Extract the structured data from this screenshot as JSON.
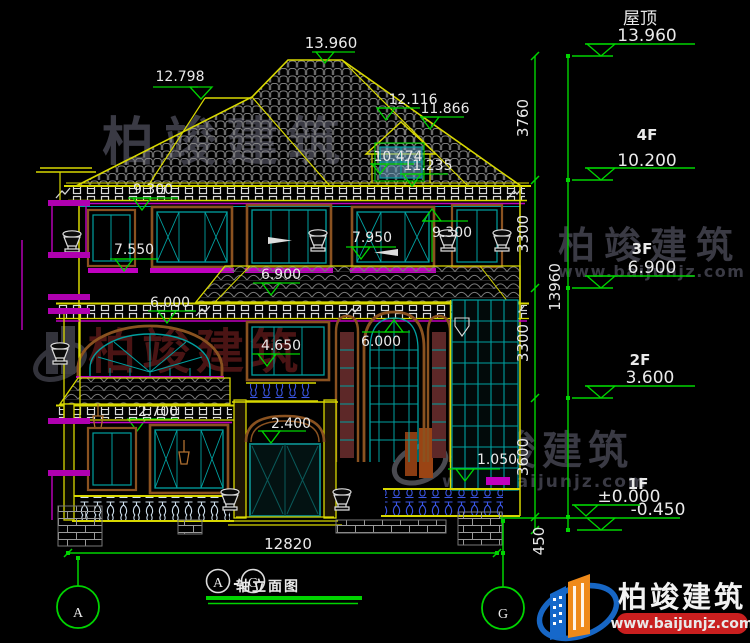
{
  "levels": [
    {
      "name": "屋顶",
      "elev": "13.960"
    },
    {
      "name": "4F",
      "elev": "10.200"
    },
    {
      "name": "3F",
      "elev": "6.900"
    },
    {
      "name": "2F",
      "elev": "3.600"
    },
    {
      "name": "1F",
      "elev": "±0.000",
      "elev_below": "-0.450"
    }
  ],
  "vertical_dims": {
    "s0": "3760",
    "s1": "3300",
    "s2": "3300",
    "s3": "3600",
    "s4": "450",
    "total": "13960"
  },
  "roof_dims": {
    "ridge": "13.960",
    "left_ridge": "12.798",
    "slope": "12.116",
    "dormer_ridge": "11.866",
    "dormer_window": "10.474",
    "dormer_eave": "11.235"
  },
  "facade_dims": {
    "eave_left": "9.300",
    "eave_right": "9.300",
    "window_3f_left": "7.550",
    "window_3f_right": "7.950",
    "canopy_2f": "6.900",
    "canopy_left": "6.000",
    "arch_2f": "6.000",
    "sill_2f": "4.650",
    "porch_1f": "2.700",
    "door_1f": "2.400",
    "sill_1f": "1.050"
  },
  "ground_dim": "12820",
  "axes": {
    "left": "A",
    "right": "G"
  },
  "title": {
    "axis_start": "A",
    "separator": "-",
    "axis_end": "G",
    "label": "轴立面图"
  },
  "watermark": {
    "brand": "柏竣建筑",
    "site": "www.baijunjz.com"
  },
  "logo": {
    "brand": "柏竣建筑",
    "site": "www.baijunjz.com"
  }
}
